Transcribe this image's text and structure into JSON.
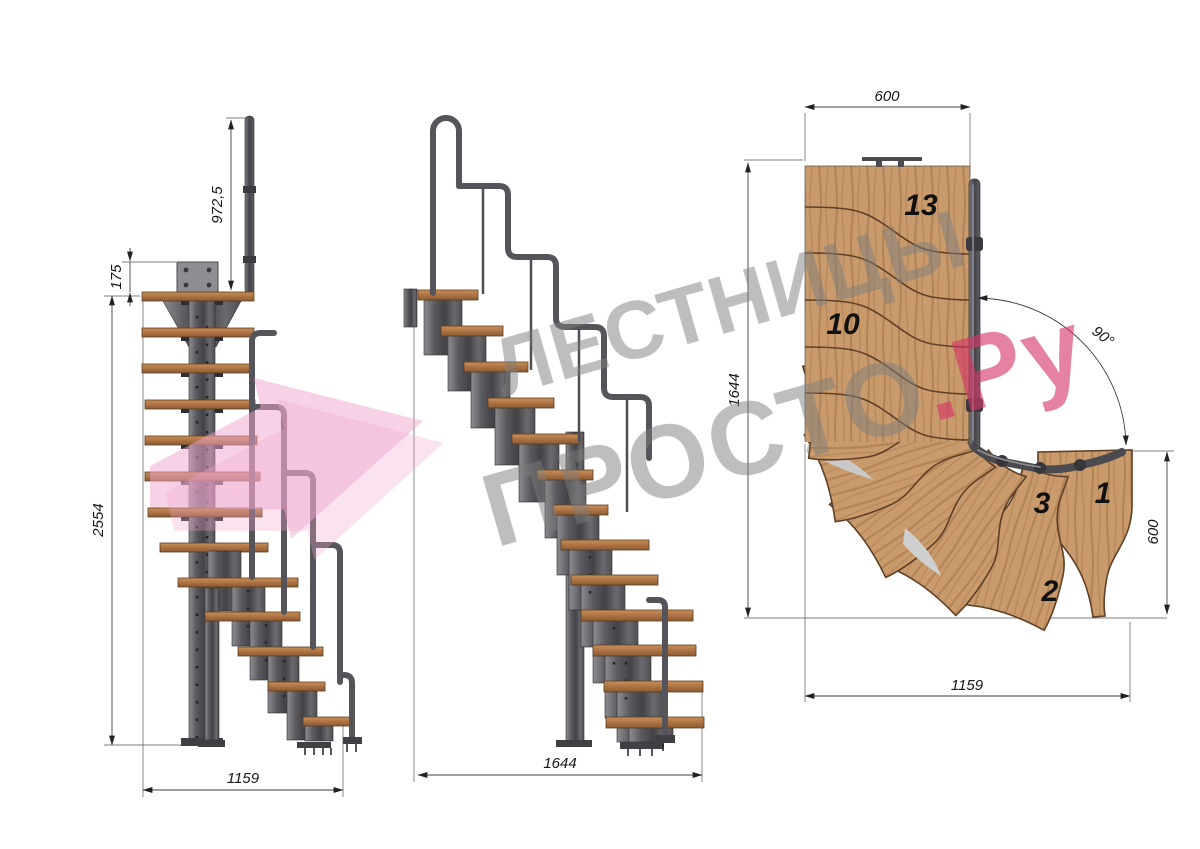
{
  "watermark": {
    "line1": "ЛЕСТНИЦЫ",
    "line2": "ПРОСТО",
    "suffix": ".Ру"
  },
  "side_view": {
    "dim_post_height": "972,5",
    "dim_plate_offset": "175",
    "dim_total_height": "2554",
    "dim_run": "1159"
  },
  "front_view": {
    "dim_run": "1644"
  },
  "plan_view": {
    "dim_top_width": "600",
    "dim_left_depth": "1644",
    "dim_turn_angle": "90°",
    "dim_right_width": "600",
    "dim_bottom_run": "1159",
    "steps": {
      "s13": "13",
      "s10": "10",
      "s3": "3",
      "s1": "1",
      "s2": "2"
    }
  }
}
